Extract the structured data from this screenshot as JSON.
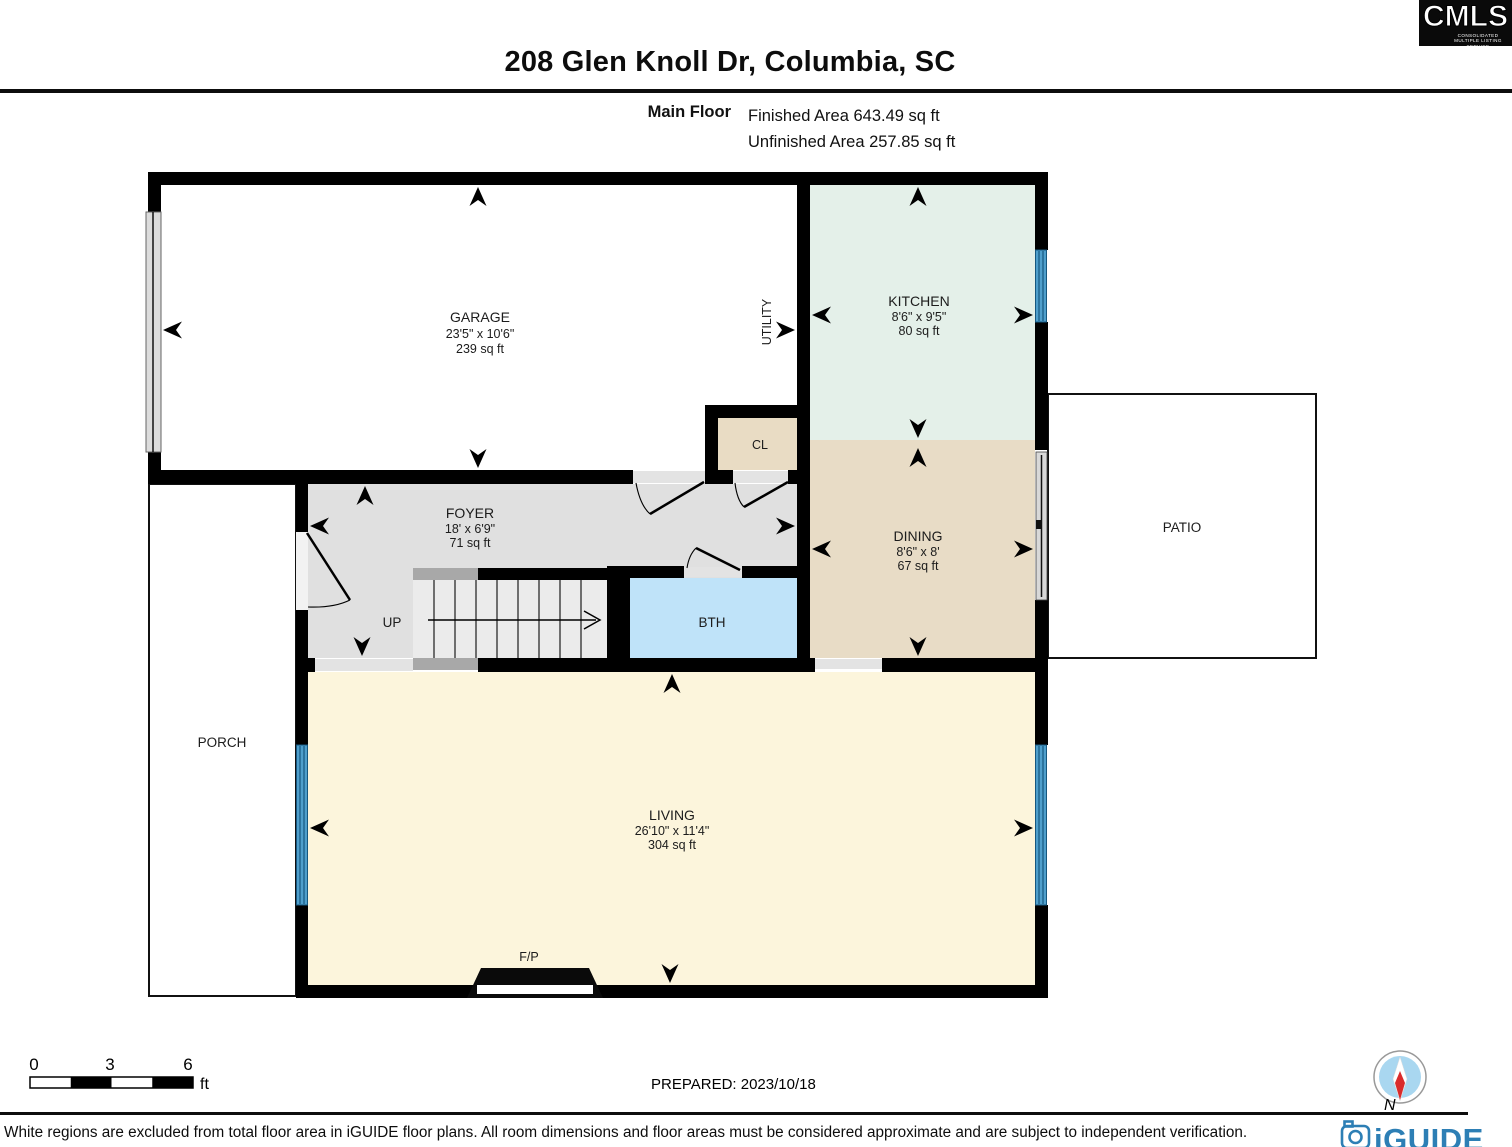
{
  "header": {
    "title": "208 Glen Knoll Dr, Columbia, SC",
    "floor_label": "Main Floor",
    "finished_area": "Finished Area 643.49 sq ft",
    "unfinished_area": "Unfinished Area 257.85 sq ft"
  },
  "cmls": {
    "name": "CMLS",
    "subtext": "CONSOLIDATED MULTIPLE LISTING SERVICE"
  },
  "rooms": {
    "garage": {
      "name": "GARAGE",
      "dims": "23'5\" x 10'6\"",
      "area": "239 sq ft"
    },
    "kitchen": {
      "name": "KITCHEN",
      "dims": "8'6\" x 9'5\"",
      "area": "80 sq ft"
    },
    "dining": {
      "name": "DINING",
      "dims": "8'6\" x 8'",
      "area": "67 sq ft"
    },
    "foyer": {
      "name": "FOYER",
      "dims": "18' x 6'9\"",
      "area": "71 sq ft"
    },
    "living": {
      "name": "LIVING",
      "dims": "26'10\" x 11'4\"",
      "area": "304 sq ft"
    },
    "utility": {
      "name": "UTILITY"
    },
    "closet": {
      "name": "CL"
    },
    "bath": {
      "name": "BTH"
    },
    "stairs": {
      "label": "UP"
    },
    "porch": {
      "name": "PORCH"
    },
    "patio": {
      "name": "PATIO"
    },
    "fireplace": {
      "label": "F/P"
    }
  },
  "scale_bar": {
    "ticks": [
      "0",
      "3",
      "6"
    ],
    "unit": "ft"
  },
  "footer": {
    "prepared": "PREPARED: 2023/10/18",
    "compass_label": "N",
    "disclaimer": "White regions are excluded from total floor area in iGUIDE floor plans. All room dimensions and floor areas must be considered approximate and are subject to independent verification.",
    "logo_text": "iGUIDE"
  },
  "colors": {
    "wall": "#000000",
    "kitchen_fill": "#e4f0e9",
    "dining_fill": "#e8dcc6",
    "closet_fill": "#e9dcc4",
    "living_fill": "#fcf5dc",
    "foyer_fill": "#e0e0e0",
    "bath_fill": "#bfe3f9",
    "window_blue": "#4f9fcc",
    "iguide_blue": "#2d7fb5",
    "compass_blue": "#a9d7f0",
    "compass_red": "#d92b2b"
  }
}
